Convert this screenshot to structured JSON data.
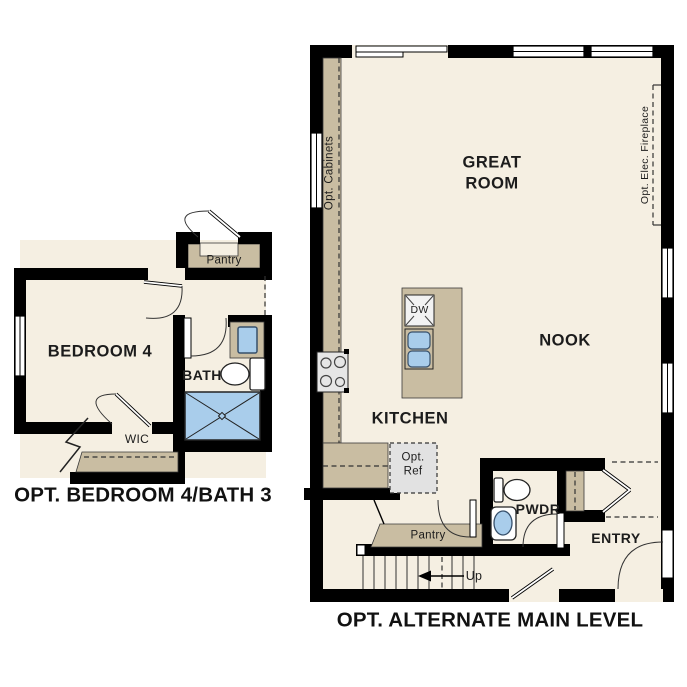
{
  "colors": {
    "wall": "#000000",
    "floor": "#f5efe2",
    "cabinetry": "#c9bda2",
    "fixture_blue": "#a9cdeb",
    "appliance_gray": "#e6e6e6"
  },
  "left_plan": {
    "title": "OPT. BEDROOM 4/BATH 3",
    "bedroom": "BEDROOM 4",
    "bath": "BATH",
    "wic": "WIC",
    "pantry": "Pantry"
  },
  "right_plan": {
    "title": "OPT. ALTERNATE MAIN LEVEL",
    "great_room": "GREAT ROOM",
    "nook": "NOOK",
    "kitchen": "KITCHEN",
    "pwdr": "PWDR",
    "entry": "ENTRY",
    "pantry": "Pantry",
    "up": "Up",
    "dw": "DW",
    "opt_cabinets": "Opt. Cabinets",
    "opt_fireplace": "Opt. Elec. Fireplace",
    "opt_ref": "Opt. Ref"
  }
}
